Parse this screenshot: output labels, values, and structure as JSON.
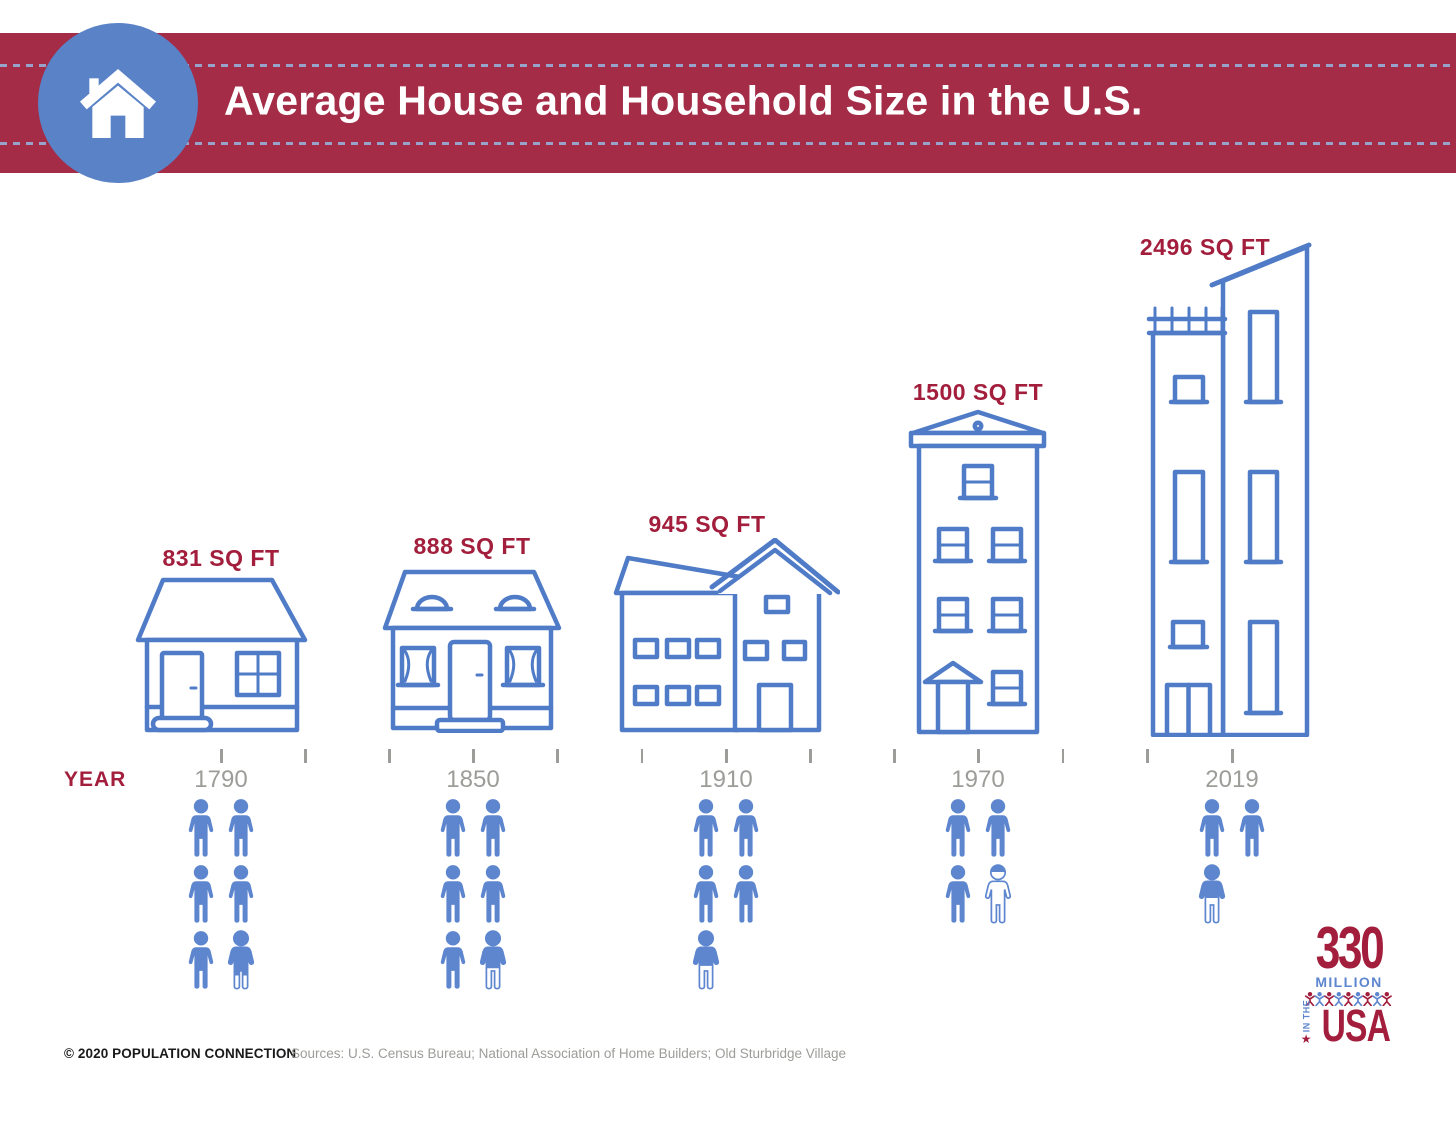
{
  "banner": {
    "title": "Average House and Household Size in the U.S."
  },
  "chart_data": {
    "type": "pictorial-bar",
    "title": "Average House and Household Size in the U.S.",
    "xlabel": "YEAR",
    "categories": [
      "1790",
      "1850",
      "1910",
      "1970",
      "2019"
    ],
    "series": [
      {
        "name": "Average house size (sq ft)",
        "values": [
          831,
          888,
          945,
          1500,
          2496
        ]
      },
      {
        "name": "Average household size (people, person icons)",
        "values": [
          5.8,
          5.6,
          4.5,
          3.1,
          2.5
        ]
      }
    ],
    "legend": "none",
    "annotations": [
      "831 SQ FT",
      "888 SQ FT",
      "945 SQ FT",
      "1500 SQ FT",
      "2496 SQ FT"
    ]
  },
  "houses": [
    {
      "year": "1790",
      "sqft_label": "831 SQ FT"
    },
    {
      "year": "1850",
      "sqft_label": "888 SQ FT"
    },
    {
      "year": "1910",
      "sqft_label": "945 SQ FT"
    },
    {
      "year": "1970",
      "sqft_label": "1500 SQ FT"
    },
    {
      "year": "2019",
      "sqft_label": "2496 SQ FT"
    }
  ],
  "timeline": {
    "axis_label": "YEAR",
    "years": [
      "1790",
      "1850",
      "1910",
      "1970",
      "2019"
    ]
  },
  "people_groups": [
    {
      "year": "1790",
      "icons": 6,
      "partial_fill": 0.74
    },
    {
      "year": "1850",
      "icons": 6,
      "partial_fill": 0.62
    },
    {
      "year": "1910",
      "icons": 5,
      "partial_fill": 0.58
    },
    {
      "year": "1970",
      "icons": 4,
      "partial_fill": 0.12
    },
    {
      "year": "2019",
      "icons": 3,
      "partial_fill": 0.55
    }
  ],
  "footer": {
    "copyright": "© 2020 POPULATION CONNECTION",
    "sources": "Sources: U.S. Census Bureau; National Association of Home Builders; Old Sturbridge Village"
  },
  "logo": {
    "number": "330",
    "million": "MILLION",
    "in_the": "IN THE",
    "usa": "USA",
    "star": "★",
    "people_count": 9
  },
  "colors": {
    "banner_red": "#A42C47",
    "accent_red": "#A21E3C",
    "house_blue": "#4F7BC7",
    "people_blue": "#5D86CF",
    "circle_blue": "#5A82C7",
    "year_gray": "#9C9C99",
    "text_dark": "#1A1A1A",
    "source_gray": "#9C9C98",
    "dash_blue": "#98A3CB"
  }
}
